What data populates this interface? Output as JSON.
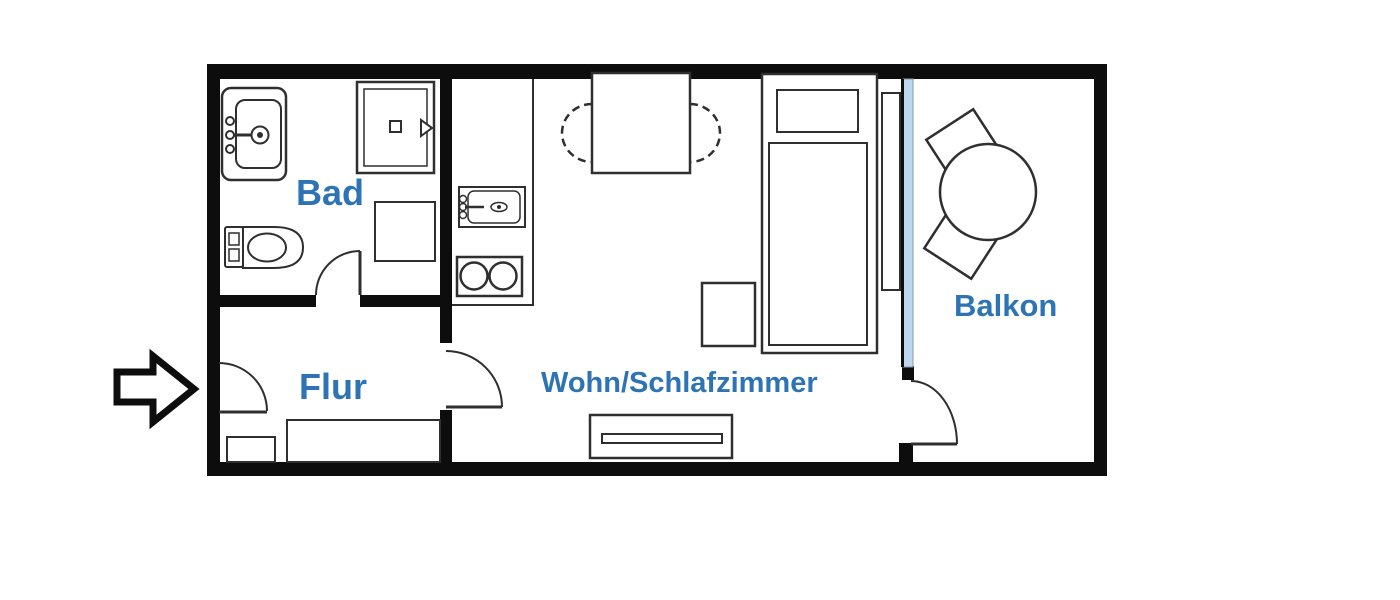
{
  "plan": {
    "type": "apartment-floor-plan",
    "colors": {
      "wall": "#0d0d0d",
      "line": "#2f2f2f",
      "room_label": "#2E74B5",
      "window_glass": "#BDD7EE",
      "background": "#ffffff"
    },
    "rooms": {
      "bad": {
        "label": "Bad",
        "fixtures": [
          "washbasin",
          "shower",
          "toilet",
          "washing-machine",
          "door"
        ]
      },
      "flur": {
        "label": "Flur",
        "fixtures": [
          "entrance-door",
          "cabinet",
          "wardrobe",
          "door-to-living-room"
        ]
      },
      "wohnschlafzimmer": {
        "label": "Wohn/Schlafzimmer",
        "fixtures": [
          "kitchen-counter",
          "kitchen-sink",
          "two-burner-stove",
          "dining-table",
          "two-chairs",
          "single-bed",
          "pillow",
          "mattress",
          "nightstand",
          "radiator",
          "sideboard"
        ]
      },
      "balkon": {
        "label": "Balkon",
        "fixtures": [
          "round-table",
          "two-chairs",
          "balcony-door",
          "window-front"
        ]
      }
    },
    "annotations": {
      "entrance_arrow_icon": "arrow-right-entrance"
    }
  }
}
